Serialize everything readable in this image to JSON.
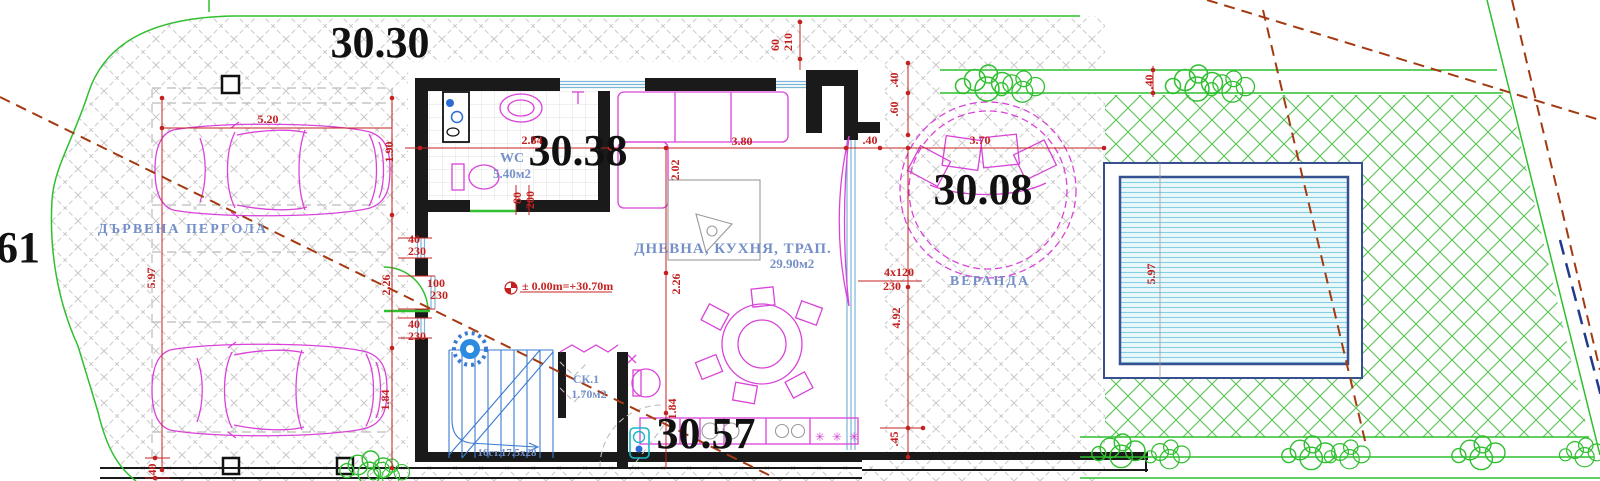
{
  "labels": {
    "elev_pergola": "30.30",
    "elev_wc": "30.38",
    "elev_veranda": "30.08",
    "elev_kitchen": "30.57",
    "elev_left_partial": "61"
  },
  "rooms": {
    "pergola": "ДЪРВЕНА ПЕРГОЛА",
    "wc_name": "WC",
    "wc_area": "5.40м2",
    "living_name": "ДНЕВНА, КУХНЯ, ТРАП.",
    "living_area": "29.90м2",
    "veranda": "ВЕРАНДА",
    "closet_name": "СК.1",
    "closet_area": "1.70м2",
    "stairs_note": "16ст.17.5х28"
  },
  "level_mark": "± 0.00m=+30.70m",
  "symbols": {
    "kitchen_hob": "✳ ✳ ✳"
  },
  "dims": {
    "car1_length": "5.20",
    "car1_width": "1.90",
    "pergola_depth": "5.97",
    "car2_width": "1.84",
    "corner_40_bl": ".40",
    "wc_width": "2.84",
    "living_width": "3.80",
    "daybed_diameter": "3.70",
    "sofa_zone_depth": "2.02",
    "dining_zone_depth": "2.26",
    "left_zone_depth": "2.26",
    "kitchen_depth": "1.84",
    "window1_w": "40",
    "window1_h": "230",
    "door_main_w": "100",
    "door_main_h": "230",
    "window2_w": "40",
    "window2_h": "230",
    "wc_door_w": "80",
    "wc_door_h": "200",
    "top_win_60": "60",
    "top_win_210": "210",
    "offset_40_top": ".40",
    "offset_60": ".60",
    "offset_40_wall": ".40",
    "offset_40_lawn": ".40",
    "glazing": "4x120",
    "glazing_h": "230",
    "glazing_length": "4.92",
    "step_45": ".45",
    "pool_length": "5.97"
  },
  "colors": {
    "wall": "#1a1a1a",
    "dim_red": "#c42020",
    "magenta": "#d943d9",
    "label_blue": "#7590c8",
    "boundary_green": "#2fbf2f",
    "lattice_green": "#5ec45e",
    "pool_border": "#37508f",
    "pool_water_line": "#86cfe0",
    "hatch_grey": "#c9c9c9",
    "setback_red": "#a33a12",
    "stairs_blue": "#3a7bd0",
    "cyan_fixture": "#16b8c8",
    "window_cyan": "#7ab4d6",
    "navy_boundary": "#223a8c"
  }
}
